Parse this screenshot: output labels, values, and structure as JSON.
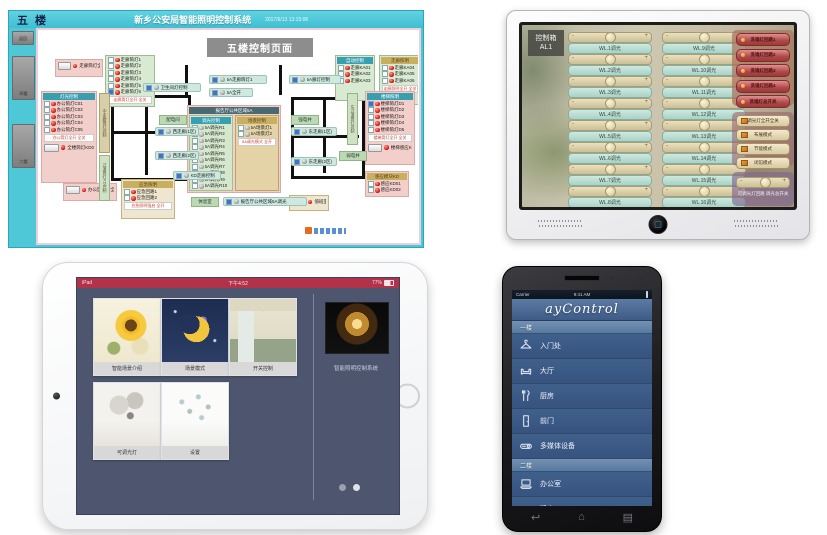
{
  "scada": {
    "floor_tab": "五 楼",
    "app_title": "新乡公安局智能照明控制系统",
    "datetime": "2017/6/13 13:15:06",
    "page_title": "五楼控制页面",
    "sidebar_buttons": [
      "返回",
      "四楼",
      "六楼"
    ],
    "zones": [
      {
        "type": "btnrow",
        "style": "pink",
        "x": 16,
        "y": 28,
        "w": 48,
        "h": 18,
        "label": "走廊筒灯全开"
      },
      {
        "type": "list",
        "style": "green",
        "x": 66,
        "y": 24,
        "w": 50,
        "h": 52,
        "rows": [
          "走廊筒灯1",
          "走廊筒灯2",
          "走廊筒灯3",
          "走廊筒灯4",
          "走廊筒灯5",
          "走廊筒灯6"
        ],
        "footer": "走廊筒灯全开 全关"
      },
      {
        "type": "list",
        "style": "pink",
        "x": 2,
        "y": 60,
        "w": 56,
        "h": 92,
        "header": "灯光控制",
        "headerStyle": "teal",
        "rows": [
          "办公筒灯C01",
          "办公筒灯C02",
          "办公筒灯C03",
          "办公筒灯C04",
          "办公筒灯C05"
        ],
        "footer": "办公筒灯全开 全关",
        "extraBtn": "全楼筒灯KD01"
      },
      {
        "type": "dual",
        "x": 148,
        "y": 74,
        "w": 94,
        "h": 88,
        "header": "报告厅公共区域5A",
        "leftHeader": "调光控制",
        "leftRows": [
          "5A调光R1",
          "5A调光R2",
          "5A调光R3",
          "5A调光R4",
          "5A调光R5",
          "5A调光R6",
          "5A调光R7",
          "5A调光R8",
          "5A调光R9",
          "5A调光R10"
        ],
        "rightHeader": "场景控制",
        "rightRows": [
          "5A场景灯1",
          "5A场景灯2"
        ],
        "rightFooter": "5A调光模式 全开"
      },
      {
        "type": "list",
        "style": "green",
        "x": 296,
        "y": 24,
        "w": 40,
        "h": 46,
        "header": "自动控制",
        "headerStyle": "teal",
        "rows": [
          "走廊KA01",
          "走廊KA02",
          "走廊KA03"
        ]
      },
      {
        "type": "list",
        "style": "green",
        "x": 340,
        "y": 24,
        "w": 42,
        "h": 50,
        "header": "走廊照明",
        "headerStyle": "tan",
        "rows": [
          "走廊KA04",
          "走廊KA05",
          "走廊KA06"
        ],
        "footer": "走廊照明全开 全关"
      },
      {
        "type": "list",
        "style": "pink",
        "x": 326,
        "y": 60,
        "w": 50,
        "h": 74,
        "header": "楼梯照明",
        "headerStyle": "teal",
        "rows": [
          "楼梯筒灯D1",
          "楼梯筒灯D2",
          "楼梯筒灯D3",
          "楼梯筒灯D4",
          "楼梯筒灯D5"
        ],
        "footer": "楼梯筒灯全开 全关",
        "extraBtn": "楼梯感应KD"
      },
      {
        "type": "list",
        "style": "pink",
        "x": 326,
        "y": 140,
        "w": 44,
        "h": 26,
        "header": "感应模块KD",
        "headerStyle": "tan",
        "rows": [
          "感应KD01",
          "感应KD02"
        ]
      },
      {
        "type": "btnrow",
        "style": "pink",
        "x": 24,
        "y": 152,
        "w": 54,
        "h": 18,
        "label": "办公区全开全关"
      },
      {
        "type": "list",
        "style": "tan",
        "x": 82,
        "y": 148,
        "w": 54,
        "h": 40,
        "header": "应急照明",
        "headerStyle": "tan",
        "rows": [
          "应急回路1",
          "应急回路2"
        ],
        "footer": "应急照明强启 全开"
      },
      {
        "type": "btnrow",
        "style": "tan",
        "x": 250,
        "y": 164,
        "w": 40,
        "h": 16,
        "label": "值班室"
      }
    ],
    "sliderlines": [
      {
        "x": 104,
        "y": 52,
        "w": 58,
        "label": "卫生间灯控制"
      },
      {
        "x": 170,
        "y": 44,
        "w": 58,
        "label": "5A走廊筒灯1"
      },
      {
        "x": 170,
        "y": 57,
        "w": 44,
        "label": "5A全开"
      },
      {
        "x": 250,
        "y": 44,
        "w": 52,
        "label": "5A廊灯控制"
      },
      {
        "x": 116,
        "y": 96,
        "w": 44,
        "label": "西走廊(1区)"
      },
      {
        "x": 116,
        "y": 120,
        "w": 44,
        "label": "西走廊(2区)"
      },
      {
        "x": 252,
        "y": 96,
        "w": 46,
        "label": "东走廊(1区)"
      },
      {
        "x": 252,
        "y": 126,
        "w": 46,
        "label": "东走廊(2区)"
      },
      {
        "x": 134,
        "y": 140,
        "w": 48,
        "label": "KD走廊控制"
      },
      {
        "x": 184,
        "y": 166,
        "w": 84,
        "label": "报告厅公共区域5A调光"
      }
    ],
    "chips": [
      {
        "x": 120,
        "y": 84,
        "w": 26,
        "label": "配电间"
      },
      {
        "x": 252,
        "y": 84,
        "w": 26,
        "label": "强电井"
      },
      {
        "x": 300,
        "y": 120,
        "w": 26,
        "label": "弱电井"
      },
      {
        "x": 152,
        "y": 166,
        "w": 26,
        "label": "休息室"
      }
    ],
    "strips": [
      {
        "x": 60,
        "y": 62,
        "h": 58,
        "label": "中走廊筒灯控制",
        "green": false
      },
      {
        "x": 60,
        "y": 124,
        "h": 44,
        "label": "过道筒灯KD控制",
        "green": true
      },
      {
        "x": 308,
        "y": 62,
        "h": 50,
        "label": "东过道筒灯控制",
        "green": true
      }
    ]
  },
  "panel": {
    "box_label_line1": "控制箱",
    "box_label_line2": "AL1",
    "sliders_left": [
      "WL.1调光",
      "WL.2调光",
      "WL.3调光",
      "WL.4调光",
      "WL.5调光",
      "WL.6调光",
      "WL.7调光",
      "WL.8调光"
    ],
    "sliders_right": [
      "WL.9调光",
      "WL.10调光",
      "WL.11调光",
      "WL.12调光",
      "WL.13调光",
      "WL.14调光",
      "WL.15调光",
      "WL.16调光"
    ],
    "wall_washer_buttons": [
      "洗墙灯回路1",
      "洗墙灯回路2",
      "洗墙灯回路3",
      "洗墙灯回路4",
      "洗墙灯总开关"
    ],
    "mode_buttons": [
      "调光灯全开全关",
      "布展模式",
      "节能模式",
      "闭馆模式"
    ],
    "master_dimmer_label": "可调光灯回路 调光总开关",
    "minus": "-",
    "plus": "+"
  },
  "tablet": {
    "status_left": "iPad",
    "status_time": "下午4:52",
    "status_battery": "77%",
    "tiles": [
      {
        "label": "智能场景介绍",
        "art": "sunflower"
      },
      {
        "label": "场景模式",
        "art": "moon"
      },
      {
        "label": "开关控制",
        "art": "kitchen"
      },
      {
        "label": "可调光灯",
        "art": "lamp"
      },
      {
        "label": "设置",
        "art": "flowers"
      }
    ],
    "right_title": "智能照明控制系统"
  },
  "phone": {
    "status_carrier": "Carrier",
    "status_time": "9:41 AM",
    "app_title": "ayControl",
    "sections": [
      {
        "label": "一楼",
        "items": [
          {
            "icon": "hanger",
            "label": "入门处"
          },
          {
            "icon": "sofa",
            "label": "大厅"
          },
          {
            "icon": "cutlery",
            "label": "厨房"
          },
          {
            "icon": "door",
            "label": "前门"
          },
          {
            "icon": "projector",
            "label": "多媒体设备"
          }
        ]
      },
      {
        "label": "二楼",
        "items": [
          {
            "icon": "laptop",
            "label": "办公室"
          },
          {
            "icon": "bed",
            "label": "睡房"
          }
        ]
      }
    ],
    "nav_icons": [
      "back",
      "home",
      "menu"
    ]
  },
  "colors": {
    "scada_teal": "#4ec7d6",
    "tablet_statusbar_red": "#b23249",
    "phone_header_blue": "#3d5b86",
    "panel_button_red": "#b04848",
    "indicator_red": "#cf1010"
  }
}
